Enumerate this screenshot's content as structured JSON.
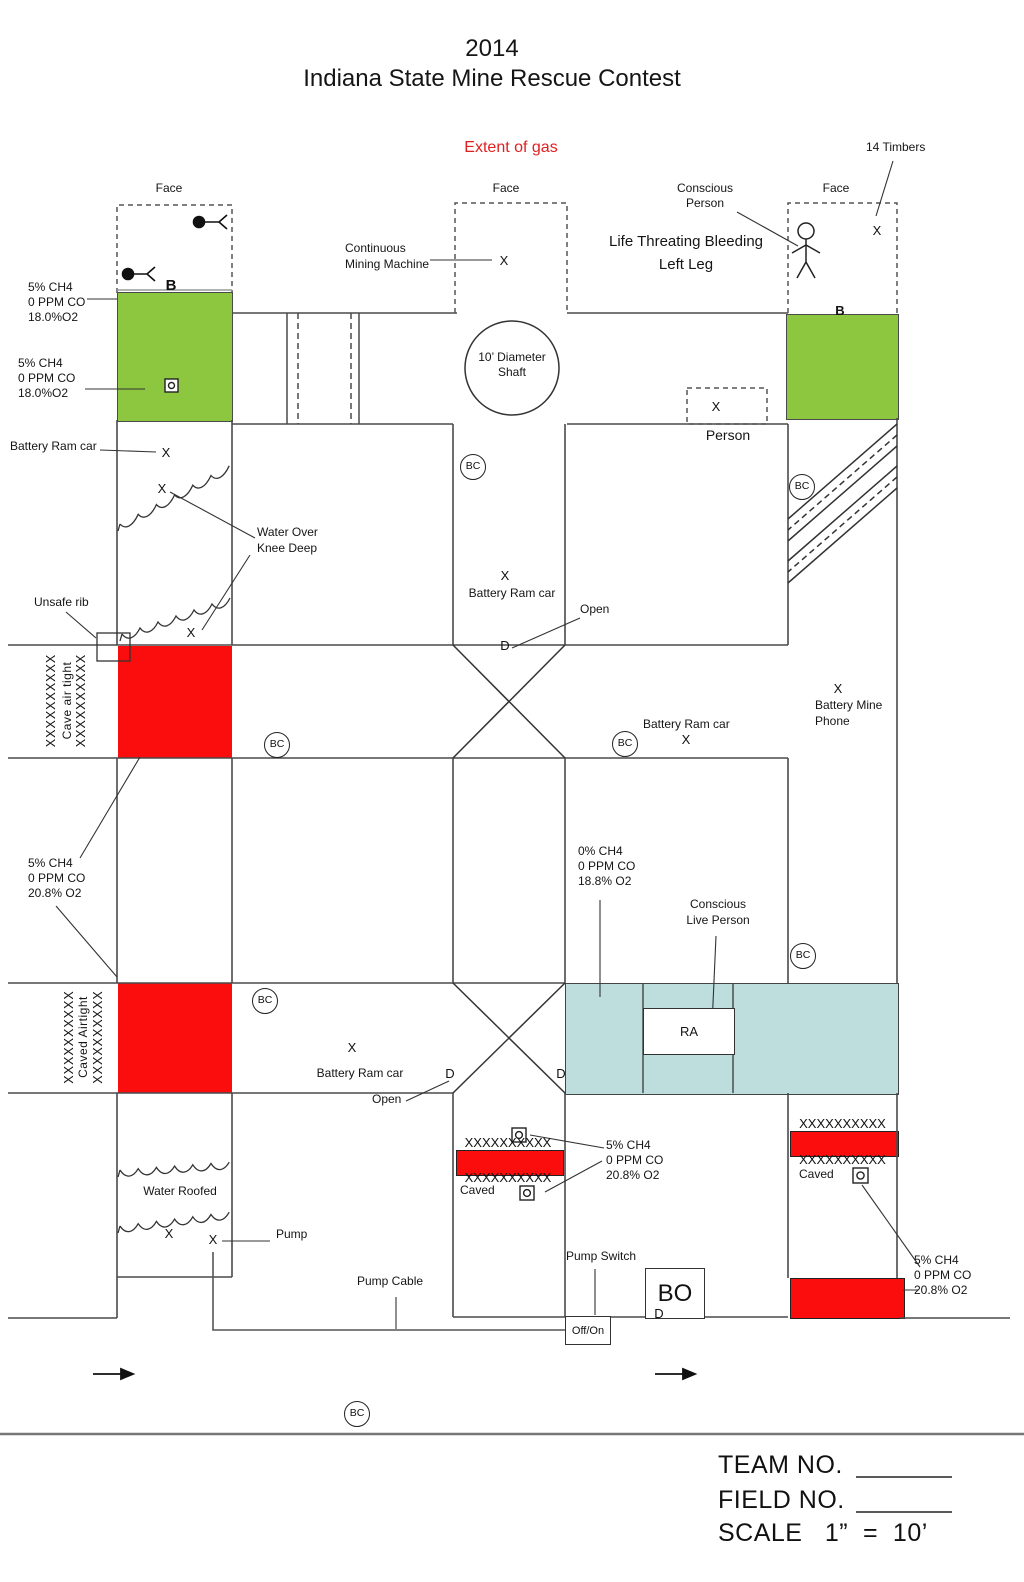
{
  "header": {
    "year": "2014",
    "title": "Indiana State Mine Rescue Contest",
    "extent": "Extent of gas"
  },
  "labels": {
    "face": "Face",
    "timbers": "14 Timbers",
    "conscious_person": "Conscious\nPerson",
    "life_threat": "Life Threating Bleeding\nLeft Leg",
    "cmm": "Continuous\nMining Machine",
    "shaft": "10’ Diameter\nShaft",
    "person": "Person",
    "gas_left_top": "5% CH4\n0 PPM CO\n18.0%O2",
    "gas_left_mid": "5% CH4\n0 PPM CO\n18.0%O2",
    "gas_left_low": "5% CH4\n0 PPM CO\n20.8% O2",
    "gas_center": "0% CH4\n0 PPM CO\n18.8% O2",
    "gas_caved_center": "5% CH4\n0 PPM CO\n20.8% O2",
    "gas_caved_right": "5% CH4\n0 PPM CO\n20.8% O2",
    "battery_ram": "Battery Ram car",
    "battery_mine_phone": "Battery Mine\nPhone",
    "water_over": "Water Over\nKnee Deep",
    "water_roofed": "Water Roofed",
    "unsafe_rib": "Unsafe rib",
    "cave_air_tight": "Cave air tight",
    "caved_airtight": "Caved Airtight",
    "caved": "Caved",
    "open": "Open",
    "conscious_live": "Conscious\nLive Person",
    "pump": "Pump",
    "pump_cable": "Pump Cable",
    "pump_switch": "Pump Switch",
    "off_on": "Off/On",
    "bo": "BO",
    "ra": "RA"
  },
  "markers": {
    "x": "X",
    "d": "D",
    "b": "B",
    "bc": "BC"
  },
  "hatch": {
    "row": "XXXXXXXXXX",
    "col": "XXXXXXXXXX"
  },
  "footer": {
    "team": "TEAM NO.",
    "field": "FIELD NO.",
    "scale": "SCALE   1”  =  10’"
  },
  "colors": {
    "gas_zone_green": "#8dc63f",
    "caved_red": "#fc0d0d",
    "fresh_air_teal": "#bedddd",
    "line": "#4a4a4a",
    "extent_text_red": "#e02020"
  }
}
